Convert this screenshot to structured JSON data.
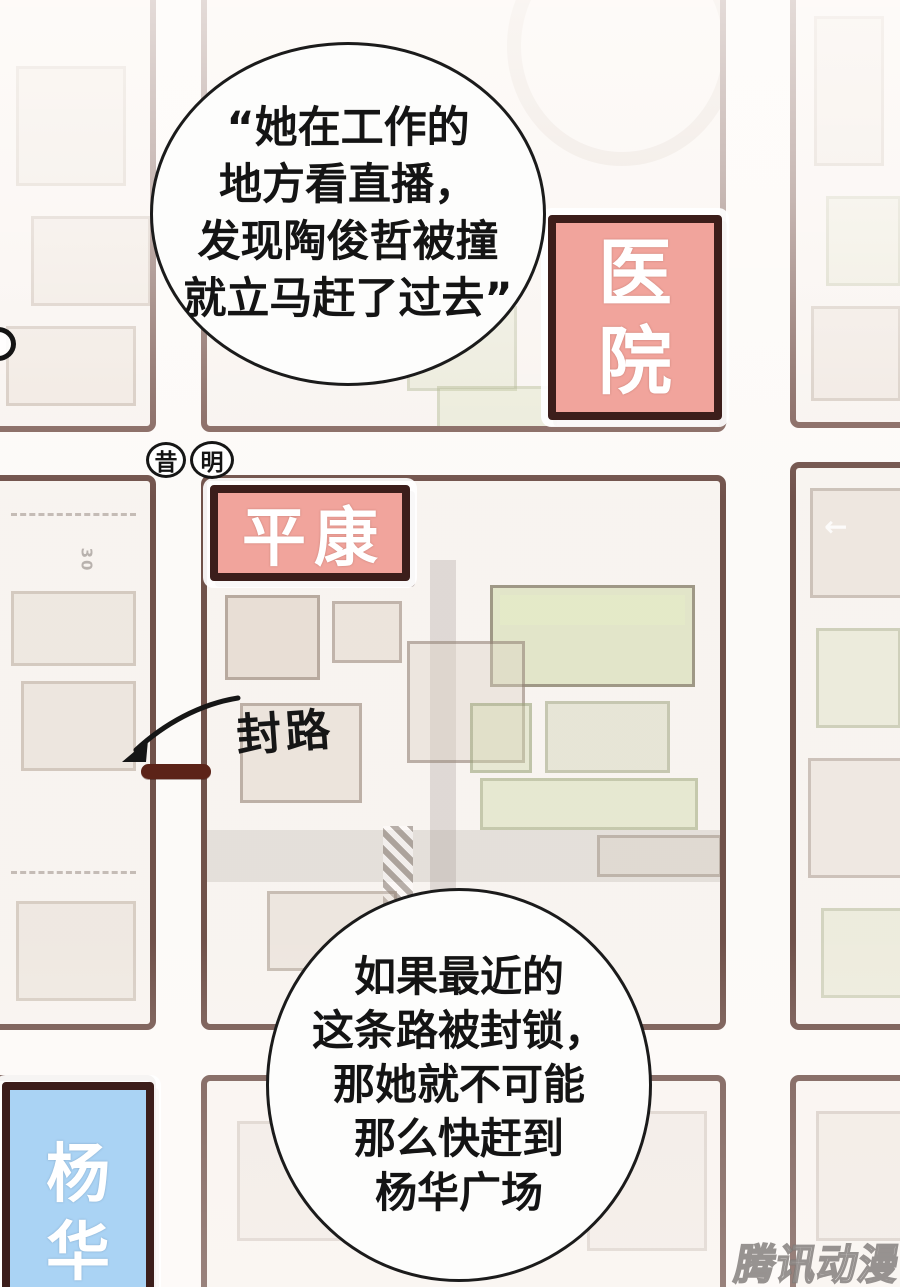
{
  "page": {
    "watermark": "腾讯动漫"
  },
  "bubbles": {
    "top": {
      "lines": [
        "“她在工作的",
        "地方看直播，",
        "发现陶俊哲被撞",
        "就立马赶了过去”"
      ]
    },
    "bottom": {
      "lines": [
        "如果最近的",
        "这条路被封锁，",
        "那她就不可能",
        "那么快赶到",
        "杨华广场"
      ]
    }
  },
  "map": {
    "signs": {
      "hospital": {
        "label": "医院",
        "chars": [
          "医",
          "院"
        ],
        "fill": "#f1a49c"
      },
      "pingkang": {
        "label": "平康",
        "fill": "#f1a49c"
      },
      "yanghua": {
        "label": "杨华",
        "chars": [
          "杨",
          "华"
        ],
        "fill": "#aad3f4"
      }
    },
    "circled_labels": [
      "昔",
      "明"
    ],
    "road_closed": {
      "label": "封路"
    },
    "road_marking_speed": "30",
    "icons": {
      "left_arrow_marking": "←"
    },
    "colors": {
      "road_border": "#553129",
      "sign_border": "#3c1e1b",
      "barrier": "#5c2318",
      "bubble_outline": "#1b1b1b",
      "bubble_fill": "#fdfdfc"
    }
  }
}
